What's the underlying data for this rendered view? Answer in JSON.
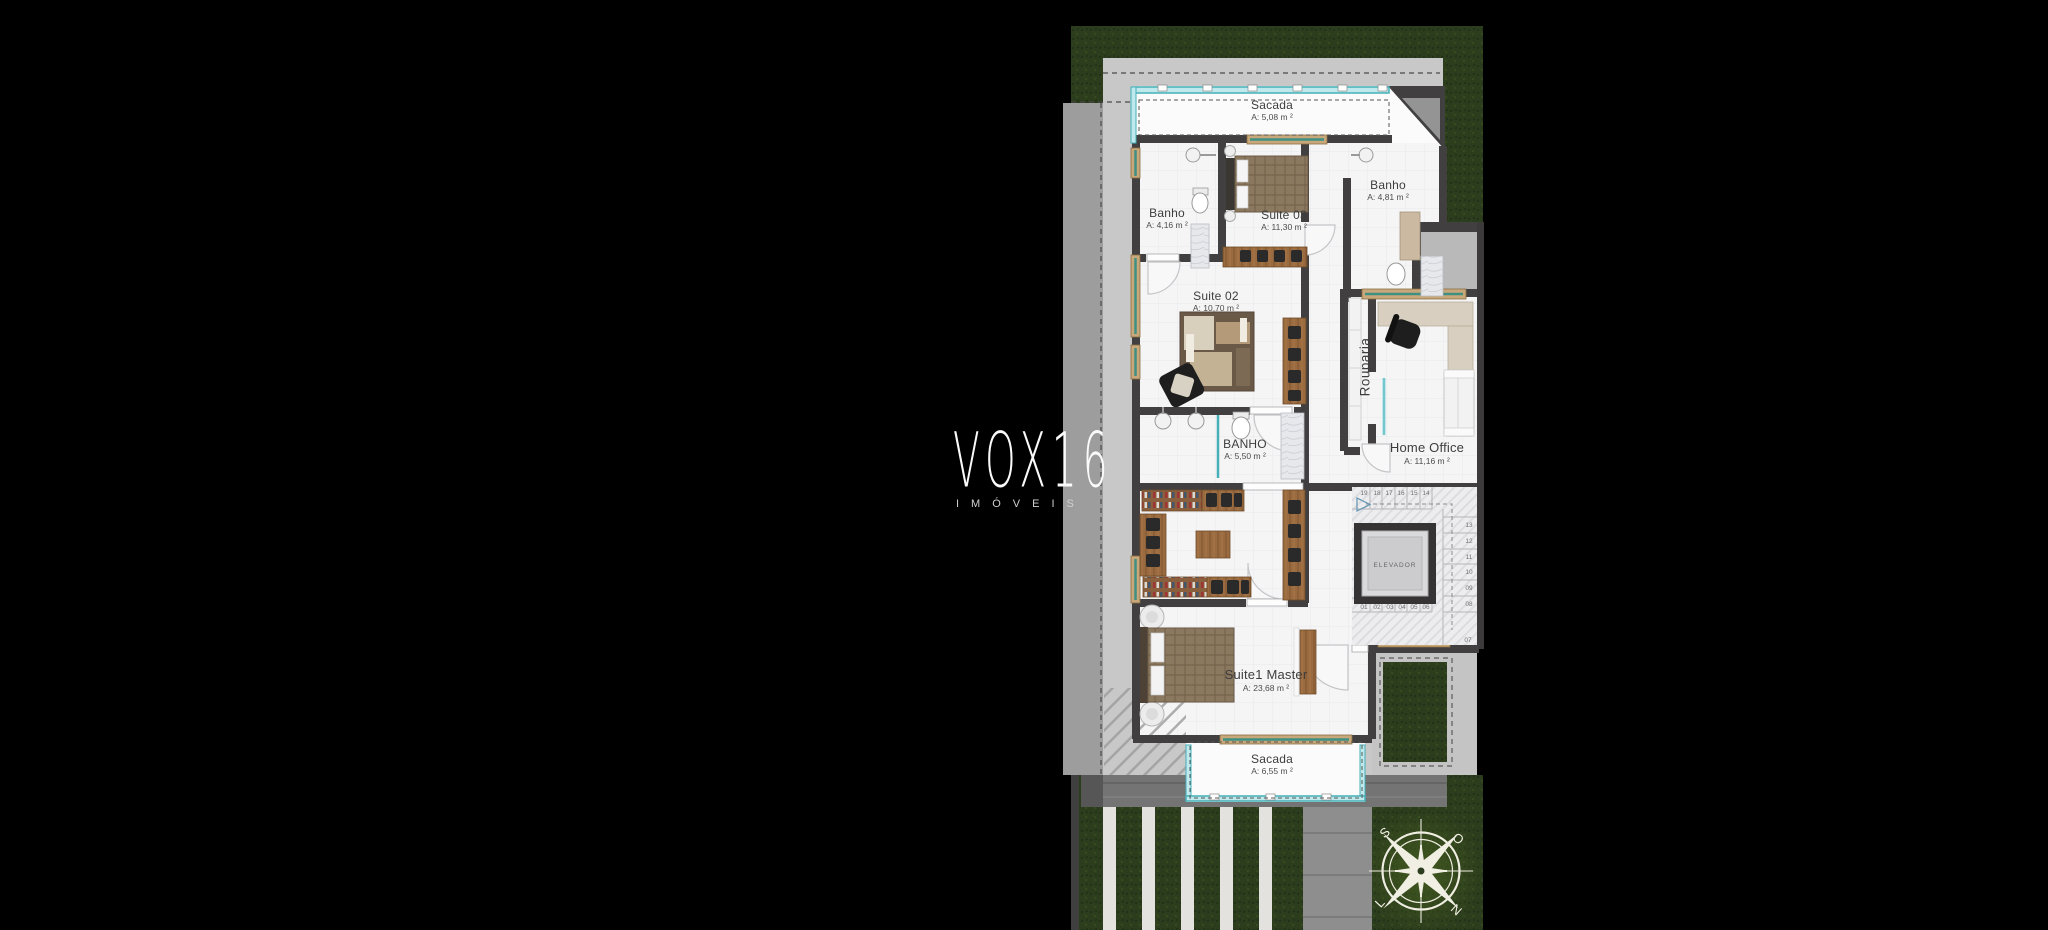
{
  "watermark": {
    "brand": "VOX16",
    "subtitle": "IMÓVEIS"
  },
  "rooms": [
    {
      "id": "sacada-top",
      "name": "Sacada",
      "area": "A: 5,08 m ²"
    },
    {
      "id": "banho-suite2",
      "name": "Banho",
      "area": "A: 4,16 m ²"
    },
    {
      "id": "suite-03",
      "name": "Suite 03",
      "area": "A: 11,30 m ²"
    },
    {
      "id": "banho-suite3",
      "name": "Banho",
      "area": "A: 4,81 m ²"
    },
    {
      "id": "suite-02",
      "name": "Suite 02",
      "area": "A: 10,70 m ²"
    },
    {
      "id": "banho-master",
      "name": "BANHO",
      "area": "A: 5,50 m ²"
    },
    {
      "id": "rouparia",
      "name": "Rouparia",
      "area": ""
    },
    {
      "id": "home-office",
      "name": "Home Office",
      "area": "A: 11,16 m ²"
    },
    {
      "id": "suite-master",
      "name": "Suite1 Master",
      "area": "A: 23,68 m ²"
    },
    {
      "id": "sacada-bottom",
      "name": "Sacada",
      "area": "A: 6,55 m ²"
    }
  ],
  "elevator": {
    "label": "ELEVADOR"
  },
  "stairs": {
    "top_row": [
      "19",
      "18",
      "17",
      "16",
      "15",
      "14"
    ],
    "right_col": [
      "13",
      "12",
      "11",
      "10",
      "09",
      "08"
    ],
    "bottom_row": [
      "01",
      "02",
      "03",
      "04",
      "05",
      "06"
    ],
    "corner": "07"
  },
  "compass": {
    "north": "N",
    "south": "S",
    "east": "L",
    "west": "O"
  },
  "colors": {
    "background": "#000000",
    "grass": "#2c3d1d",
    "pavement": "#c8c8c8",
    "sidewalk": "#9d9d9d",
    "wall": "#413f40",
    "glass_teal": "#45b0b8",
    "wood": "#9a6a40",
    "floor": "#f5f5f6"
  }
}
